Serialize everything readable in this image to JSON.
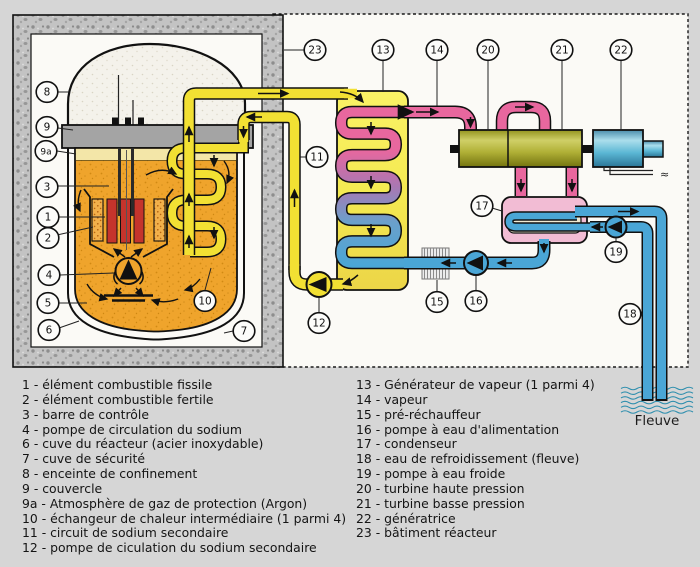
{
  "title": "Schéma d'un réacteur nucléaire à neutrons rapides refroidi au sodium",
  "markers": {
    "m1": "1",
    "m2": "2",
    "m3": "3",
    "m4": "4",
    "m5": "5",
    "m6": "6",
    "m7": "7",
    "m8": "8",
    "m9": "9",
    "m9a": "9a",
    "m10": "10",
    "m11": "11",
    "m12": "12",
    "m13": "13",
    "m14": "14",
    "m15": "15",
    "m16": "16",
    "m17": "17",
    "m18": "18",
    "m19": "19",
    "m20": "20",
    "m21": "21",
    "m22": "22",
    "m23": "23"
  },
  "legend": {
    "left": [
      "1 - élément combustible fissile",
      "2 - élément combustible fertile",
      "3 - barre de contrôle",
      "4 - pompe de circulation du sodium",
      "6 - cuve du réacteur (acier inoxydable)",
      "7 - cuve de sécurité",
      "8 - enceinte de confinement",
      "9 - couvercle",
      "9a - Atmosphère de gaz de protection (Argon)",
      "10 - échangeur de chaleur intermédiaire (1 parmi 4)",
      "11 - circuit de sodium secondaire",
      "12 - pompe de ciculation du sodium secondaire"
    ],
    "right": [
      "13 - Générateur de vapeur (1 parmi 4)",
      "14 - vapeur",
      "15 - pré-réchauffeur",
      "16 - pompe à eau d'alimentation",
      "17 - condenseur",
      "18 - eau de refroidissement (fleuve)",
      "19 - pompe à eau froide",
      "20 - turbine haute pression",
      "21 - turbine basse pression",
      "22 - génératrice",
      "23 - bâtiment réacteur"
    ]
  },
  "river": {
    "label": "Fleuve"
  },
  "electric": {
    "symbol": "≈"
  },
  "colors": {
    "sodium_primary": "#efa42c",
    "sodium_secondary": "#f2e033",
    "steam": "#e8679e",
    "water": "#4aa6d6",
    "turbine": "#b5b53a",
    "generator": "#62bcd4",
    "condenser": "#f2bcd4",
    "concrete": "#c3c3c3",
    "argon": "#f3e6a8"
  }
}
